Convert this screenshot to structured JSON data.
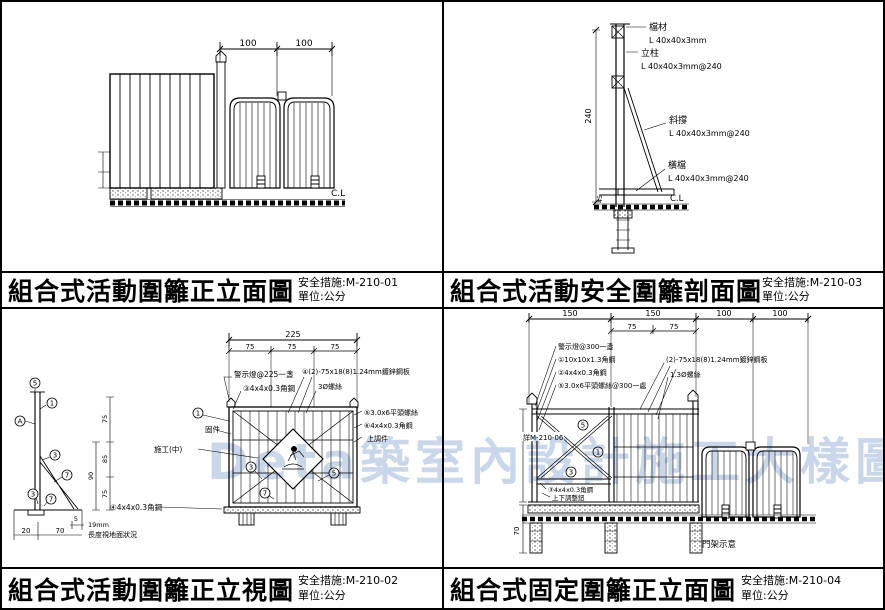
{
  "watermark": "Deta築室內設計施工大樣圖庫",
  "panels": {
    "tl": {
      "title": "組合式活動圍籬正立面圖",
      "ref": "安全措施:M-210-01",
      "unit": "單位:公分",
      "dim_100a": "100",
      "dim_100b": "100",
      "cl": "C.L"
    },
    "tr": {
      "title": "組合式活動安全圍籬剖面圖",
      "ref": "安全措施:M-210-03",
      "unit": "單位:公分",
      "cap": "檔材",
      "cap_spec": "L 40x40x3mm",
      "post": "立柱",
      "post_spec": "L 40x40x3mm@240",
      "brace": "斜撐",
      "brace_spec": "L 40x40x3mm@240",
      "rail": "橫檔",
      "rail_spec": "L 40x40x3mm@240",
      "cl": "C.L",
      "dim_height": "240",
      "dim_base": "45"
    },
    "bl": {
      "title": "組合式活動圍籬正立視圖",
      "ref": "安全措施:M-210-02",
      "unit": "單位:公分",
      "dim_total": "225",
      "s1": "75",
      "s2": "75",
      "s3": "75",
      "v1": "75",
      "v2": "85",
      "v3": "90",
      "v4": "75",
      "b_20": "20",
      "b_70": "70",
      "b_5": "5",
      "b_19": "19mm",
      "ground_note": "長度視地面狀況",
      "light": "警示燈@225一盞",
      "angle_top": "③4x4x0.3角鋼",
      "panel_spec": "④(2)-75x18(8)1.24mm鍍鋅鋼板",
      "screw": "3Ø螺絲",
      "fixture": "固件",
      "sign": "施工(中)",
      "r1": "⑤3.0x6平頭螺絲",
      "r2": "⑥4x4x0.3角鋼",
      "r3": "上調件",
      "angle_bottom": "④4x4x0.3角鋼",
      "cA": "A",
      "c1": "1",
      "c3": "3",
      "c5": "5",
      "c7": "7"
    },
    "br": {
      "title": "組合式固定圍籬正立面圖",
      "ref": "安全措施:M-210-04",
      "unit": "單位:公分",
      "d1": "150",
      "d2": "150",
      "d3": "100",
      "d4": "100",
      "s1": "75",
      "s2": "75",
      "depth": "70",
      "light": "警示燈@300一盞",
      "l2": "①10x10x1.3角鋼",
      "l3": "②4x4x0.3角鋼",
      "l4": "⑤3.0x6平頭螺絲@300一處",
      "panel_spec": "(2)-75x18(8)1.24mm鍍鋅鋼板",
      "wire": "1.3Ø螺絲",
      "detail_ref": "詳M-210-06",
      "angle_mid": "③4x4x0.3角鋼",
      "adjuster": "上下調整鈕",
      "gate_note": "門架示意",
      "c1": "1",
      "c3": "3",
      "c5": "5"
    }
  }
}
